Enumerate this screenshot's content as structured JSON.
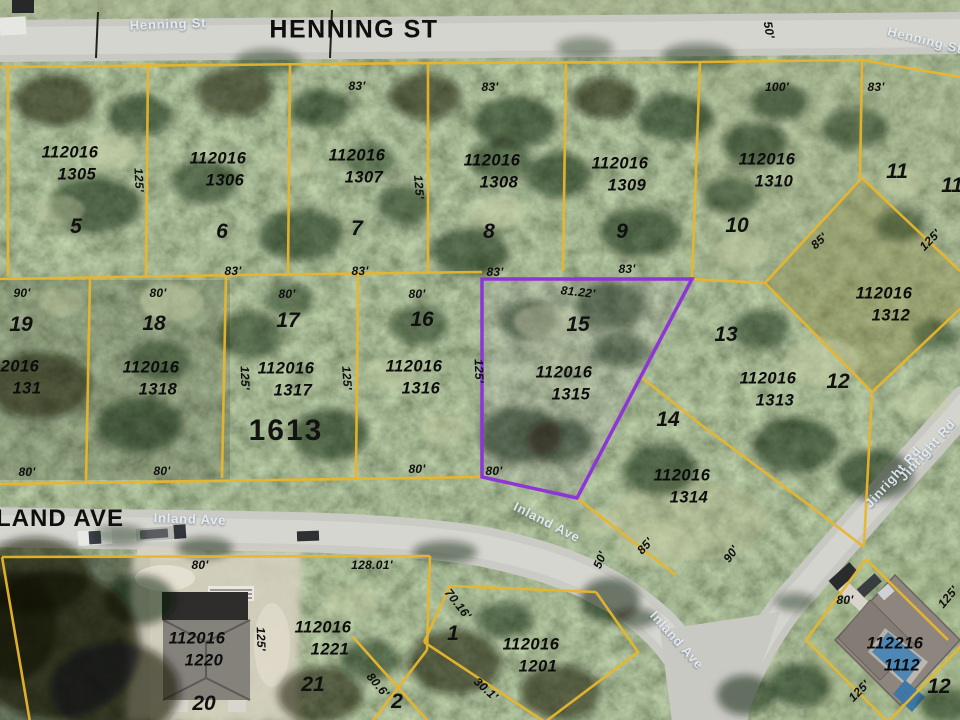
{
  "map": {
    "streets": {
      "henning_main": "HENNING ST",
      "land_ave": "LAND AVE",
      "block_number": "1613"
    },
    "street_labels": [
      {
        "text": "Henning St",
        "x": 168,
        "y": 24,
        "rot": -2
      },
      {
        "text": "Henning St",
        "x": 925,
        "y": 40,
        "rot": 14
      },
      {
        "text": "Inland Ave",
        "x": 190,
        "y": 519,
        "rot": 2
      },
      {
        "text": "Inland Ave",
        "x": 547,
        "y": 522,
        "rot": 27
      },
      {
        "text": "Inland Ave",
        "x": 677,
        "y": 640,
        "rot": 48
      },
      {
        "text": "Jinright Rd",
        "x": 893,
        "y": 477,
        "rot": -48
      },
      {
        "text": "Jinright Rd",
        "x": 927,
        "y": 450,
        "rot": -48
      }
    ],
    "parcels": [
      {
        "id1": "112016",
        "id2": "1305",
        "lot": "5",
        "idx": 70,
        "idy": 153,
        "lotx": 76,
        "loty": 227
      },
      {
        "id1": "112016",
        "id2": "1306",
        "lot": "6",
        "idx": 218,
        "idy": 159,
        "lotx": 222,
        "loty": 232
      },
      {
        "id1": "112016",
        "id2": "1307",
        "lot": "7",
        "idx": 357,
        "idy": 156,
        "lotx": 357,
        "loty": 229
      },
      {
        "id1": "112016",
        "id2": "1308",
        "lot": "8",
        "idx": 492,
        "idy": 161,
        "lotx": 489,
        "loty": 232
      },
      {
        "id1": "112016",
        "id2": "1309",
        "lot": "9",
        "idx": 620,
        "idy": 164,
        "lotx": 622,
        "loty": 232
      },
      {
        "id1": "112016",
        "id2": "1310",
        "lot": "10",
        "idx": 767,
        "idy": 160,
        "lotx": 737,
        "loty": 226
      },
      {
        "id1": "2016",
        "id2": "131",
        "lot": "19",
        "idx": 20,
        "idy": 367,
        "lotx": 21,
        "loty": 325
      },
      {
        "id1": "112016",
        "id2": "1318",
        "lot": "18",
        "idx": 151,
        "idy": 368,
        "lotx": 154,
        "loty": 324
      },
      {
        "id1": "112016",
        "id2": "1317",
        "lot": "17",
        "idx": 286,
        "idy": 369,
        "lotx": 288,
        "loty": 321
      },
      {
        "id1": "112016",
        "id2": "1316",
        "lot": "16",
        "idx": 414,
        "idy": 367,
        "lotx": 422,
        "loty": 320
      },
      {
        "id1": "112016",
        "id2": "1315",
        "lot": "15",
        "idx": 564,
        "idy": 373,
        "lotx": 578,
        "loty": 325
      },
      {
        "id1": "112016",
        "id2": "1313",
        "lot": "13",
        "idx": 768,
        "idy": 379,
        "lotx": 726,
        "loty": 335
      },
      {
        "id1": "112016",
        "id2": "1314",
        "lot": "14",
        "idx": 682,
        "idy": 476,
        "lotx": 668,
        "loty": 420
      },
      {
        "id1": "112016",
        "id2": "1312",
        "lot": "12",
        "idx": 884,
        "idy": 294,
        "lotx": 838,
        "loty": 382
      },
      {
        "id1": "112016",
        "id2": "1220",
        "lot": "20",
        "idx": 197,
        "idy": 639,
        "lotx": 204,
        "loty": 704
      },
      {
        "id1": "112016",
        "id2": "1221",
        "lot": "21",
        "idx": 323,
        "idy": 628,
        "lotx": 313,
        "loty": 685
      },
      {
        "id1": "112016",
        "id2": "1201",
        "lot": "1",
        "idx": 531,
        "idy": 645,
        "lotx": 453,
        "loty": 634
      },
      {
        "id1": "112216",
        "id2": "1112",
        "lot": "12",
        "idx": 895,
        "idy": 644,
        "lotx": 939,
        "loty": 687
      }
    ],
    "lot_only": [
      {
        "lot": "11",
        "x": 897,
        "y": 172
      },
      {
        "lot": "11",
        "x": 952,
        "y": 186
      },
      {
        "lot": "2",
        "x": 397,
        "y": 702
      }
    ],
    "dimensions": [
      {
        "t": "83'",
        "x": 357,
        "y": 86
      },
      {
        "t": "83'",
        "x": 490,
        "y": 87
      },
      {
        "t": "100'",
        "x": 777,
        "y": 87
      },
      {
        "t": "83'",
        "x": 876,
        "y": 87
      },
      {
        "t": "50'",
        "x": 769,
        "y": 30,
        "rot": 80
      },
      {
        "t": "125'",
        "x": 139,
        "y": 180,
        "rot": 87
      },
      {
        "t": "125'",
        "x": 419,
        "y": 187,
        "rot": 85
      },
      {
        "t": "83'",
        "x": 233,
        "y": 271
      },
      {
        "t": "83'",
        "x": 360,
        "y": 271
      },
      {
        "t": "83'",
        "x": 495,
        "y": 272
      },
      {
        "t": "83'",
        "x": 627,
        "y": 269
      },
      {
        "t": "90'",
        "x": 22,
        "y": 293
      },
      {
        "t": "80'",
        "x": 158,
        "y": 293
      },
      {
        "t": "80'",
        "x": 287,
        "y": 294
      },
      {
        "t": "80'",
        "x": 417,
        "y": 294
      },
      {
        "t": "81.22'",
        "x": 578,
        "y": 292,
        "rot": 6
      },
      {
        "t": "125'",
        "x": 479,
        "y": 371,
        "rot": 88
      },
      {
        "t": "125'",
        "x": 245,
        "y": 378,
        "rot": 88
      },
      {
        "t": "125'",
        "x": 347,
        "y": 378,
        "rot": 86
      },
      {
        "t": "125'",
        "x": 930,
        "y": 240,
        "rot": -45
      },
      {
        "t": "85'",
        "x": 819,
        "y": 241,
        "rot": -42
      },
      {
        "t": "80'",
        "x": 27,
        "y": 472
      },
      {
        "t": "80'",
        "x": 162,
        "y": 471
      },
      {
        "t": "80'",
        "x": 417,
        "y": 469
      },
      {
        "t": "80'",
        "x": 494,
        "y": 471
      },
      {
        "t": "50'",
        "x": 600,
        "y": 560,
        "rot": -68
      },
      {
        "t": "90'",
        "x": 731,
        "y": 554,
        "rot": -55
      },
      {
        "t": "85'",
        "x": 645,
        "y": 546,
        "rot": -48
      },
      {
        "t": "80'",
        "x": 200,
        "y": 565
      },
      {
        "t": "128.01'",
        "x": 372,
        "y": 565
      },
      {
        "t": "70.16'",
        "x": 458,
        "y": 604,
        "rot": 52
      },
      {
        "t": "30.1'",
        "x": 486,
        "y": 689,
        "rot": 42
      },
      {
        "t": "125'",
        "x": 261,
        "y": 639,
        "rot": 88
      },
      {
        "t": "80.6'",
        "x": 378,
        "y": 685,
        "rot": 50
      },
      {
        "t": "80'",
        "x": 845,
        "y": 600
      },
      {
        "t": "125'",
        "x": 948,
        "y": 597,
        "rot": -50
      },
      {
        "t": "125'",
        "x": 859,
        "y": 691,
        "rot": -45
      }
    ],
    "highlight": {
      "id": "112016 1315",
      "color": "#8d35d6"
    },
    "colors": {
      "boundary": "#e9b62c",
      "road": "#cbcbc5",
      "pool": "#4e86b4"
    }
  }
}
